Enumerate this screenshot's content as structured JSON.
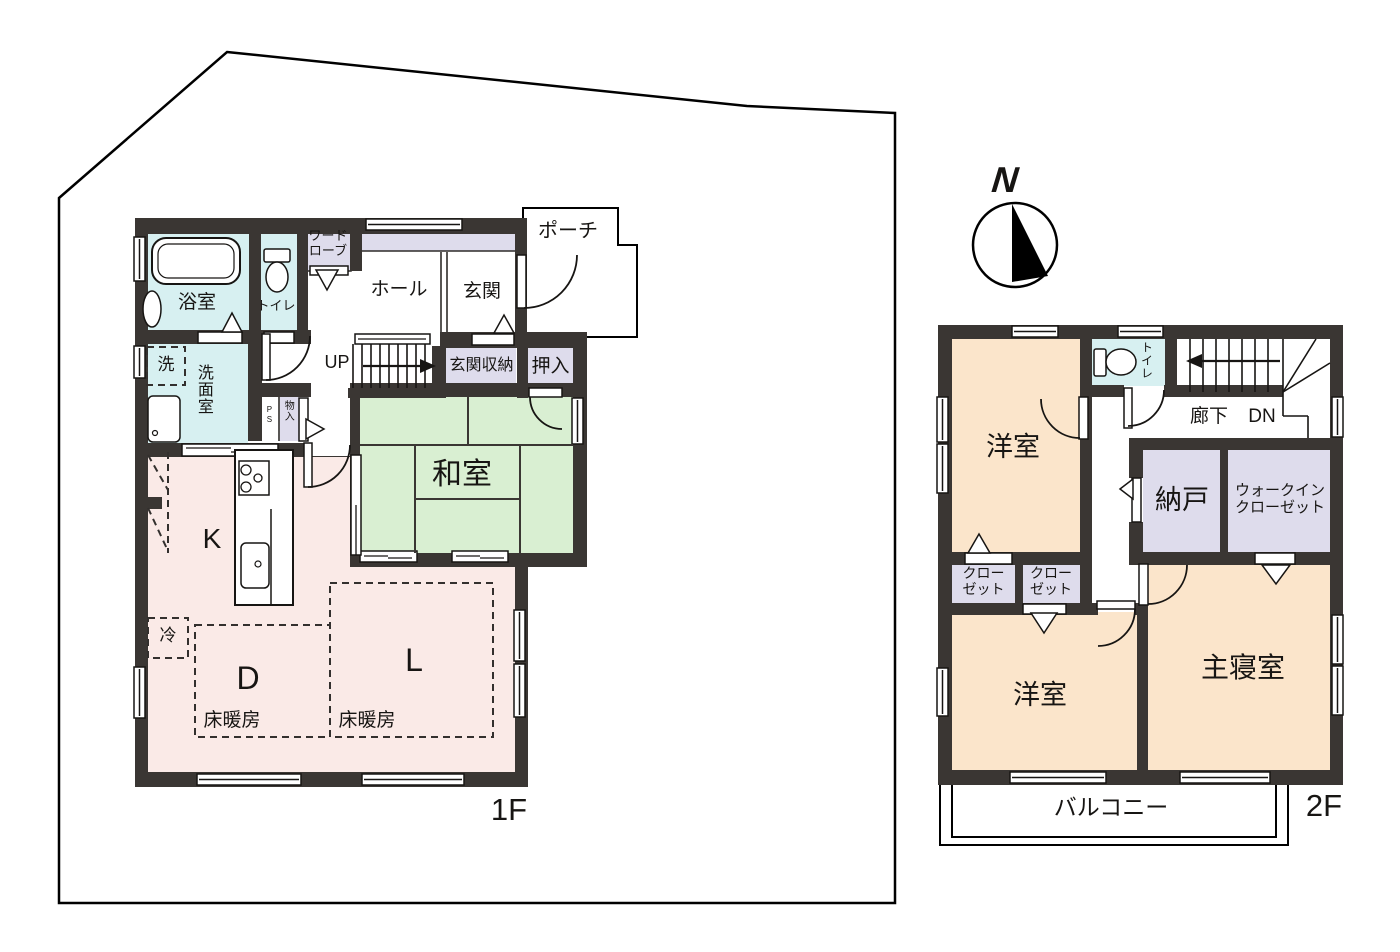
{
  "title": "house floor plan",
  "colors": {
    "wall": "#3a3633",
    "water_room": "#d7f0f1",
    "tatami": "#d9efd2",
    "ldk_pink": "#faeae7",
    "bedroom_peach": "#fbe5cb",
    "closet_lavender": "#dedcec",
    "line": "#171513"
  },
  "compass": {
    "north": "N"
  },
  "floor1": {
    "floor_label": "1F",
    "bath": "浴室",
    "toilet": "トイレ",
    "wardrobe": "ワード\nローブ",
    "hall": "ホール",
    "entrance": "玄関",
    "porch": "ポーチ",
    "stairs_up": "UP",
    "entrance_storage": "玄関収納",
    "futon_closet": "押入",
    "storage_small": "物入",
    "pipe_space": "PS",
    "washer": "洗",
    "washroom": "洗面室",
    "japanese_room": "和室",
    "kitchen": "K",
    "dining": "D",
    "living": "L",
    "floor_heating_d": "床暖房",
    "floor_heating_l": "床暖房",
    "refrigerator": "冷"
  },
  "floor2": {
    "floor_label": "2F",
    "bedroom_nw": "洋室",
    "toilet": "トイレ",
    "corridor": "廊下",
    "stairs_down": "DN",
    "storage_room": "納戸",
    "walk_in_closet": "ウォークイン\nクローゼット",
    "closet_left": "クロー\nゼット",
    "closet_right": "クロー\nゼット",
    "bedroom_sw": "洋室",
    "master_bedroom": "主寝室",
    "balcony": "バルコニー"
  }
}
